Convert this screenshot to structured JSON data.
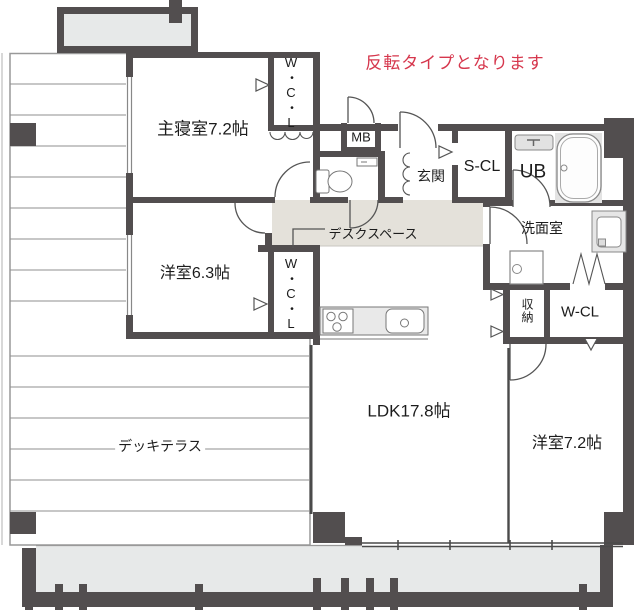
{
  "plan": {
    "note": "反転タイプとなります",
    "rooms": {
      "master_bedroom": "主寝室7.2帖",
      "western_room_6_3": "洋室6.3帖",
      "western_room_7_2": "洋室7.2帖",
      "ldk": "LDK17.8帖",
      "deck_terrace": "デッキテラス",
      "desk_space": "デスクスペース",
      "entrance": "玄関",
      "washroom": "洗面室",
      "walk_in_closet_master": "W・C・L",
      "walk_in_closet_6_3": "W・C・L",
      "closet_right": "W-CL",
      "shoe_closet": "S-CL",
      "unit_bath": "UB",
      "meter_box": "MB",
      "storage": "収納"
    },
    "colors": {
      "wall": "#524e4f",
      "corridor_floor": "#e4e1da",
      "balcony_floor": "#e7e9e9",
      "note_red": "#d6374d"
    }
  }
}
